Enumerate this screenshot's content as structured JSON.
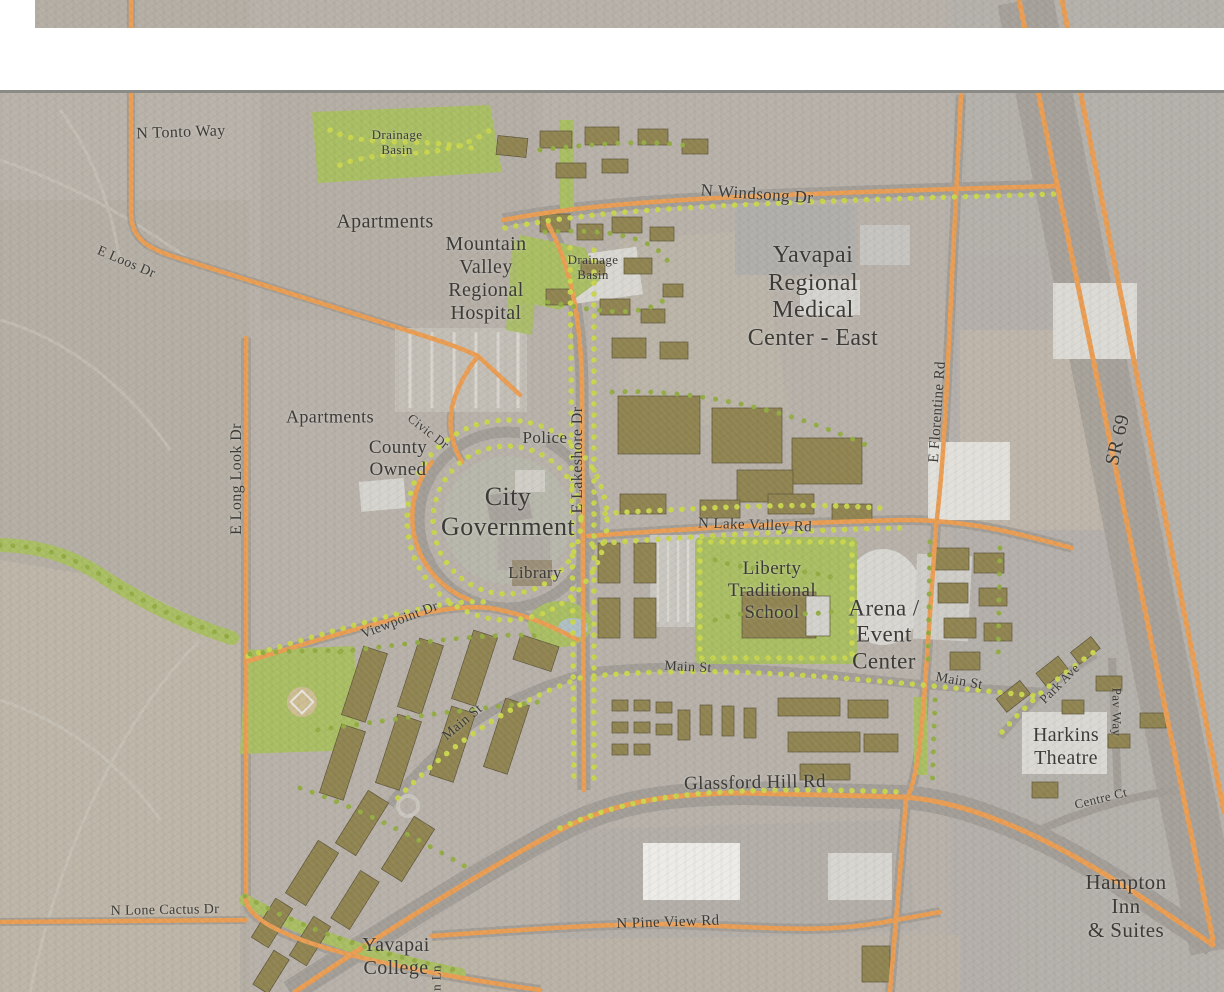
{
  "map": {
    "colors": {
      "map_base": "#B7B1A9",
      "white_band": "#FFFFFF",
      "border_line": "#8A8A86",
      "road_orange": "#EA9D52",
      "green_area": "#A9BE62",
      "building_olive": "#8F8350",
      "tree_dot": "#C9D64D",
      "tree_dot_dark": "#93AC43",
      "label_text": "#3C3B38",
      "highway_gray": "#A6A39E",
      "pond_blue": "#AEBFC4"
    },
    "labels": [
      {
        "t": "N Tonto Way",
        "x": 181,
        "y": 133,
        "r": -2,
        "fs": 16
      },
      {
        "t": "Drainage\nBasin",
        "x": 397,
        "y": 143,
        "r": 0,
        "fs": 13
      },
      {
        "t": "Apartments",
        "x": 385,
        "y": 222,
        "r": 0,
        "fs": 20
      },
      {
        "t": "Mountain\nValley\nRegional\nHospital",
        "x": 486,
        "y": 279,
        "r": 0,
        "fs": 20
      },
      {
        "t": "N Windsong Dr",
        "x": 757,
        "y": 194,
        "r": 4,
        "fs": 17
      },
      {
        "t": "Drainage\nBasin",
        "x": 593,
        "y": 268,
        "r": 0,
        "fs": 13
      },
      {
        "t": "Yavapai\nRegional\nMedical\nCenter - East",
        "x": 813,
        "y": 297,
        "r": 0,
        "fs": 24
      },
      {
        "t": "E Loos Dr",
        "x": 126,
        "y": 263,
        "r": 23,
        "fs": 14
      },
      {
        "t": "E Long Look Dr",
        "x": 237,
        "y": 479,
        "r": -90,
        "fs": 16
      },
      {
        "t": "Apartments",
        "x": 330,
        "y": 417,
        "r": 0,
        "fs": 18
      },
      {
        "t": "Civic Dr",
        "x": 428,
        "y": 432,
        "r": 38,
        "fs": 13
      },
      {
        "t": "County\nOwned",
        "x": 398,
        "y": 459,
        "r": 0,
        "fs": 19
      },
      {
        "t": "Police",
        "x": 545,
        "y": 438,
        "r": 0,
        "fs": 17
      },
      {
        "t": "City\nGovernment",
        "x": 508,
        "y": 512,
        "r": 0,
        "fs": 26
      },
      {
        "t": "Library",
        "x": 535,
        "y": 573,
        "r": 0,
        "fs": 17
      },
      {
        "t": "E Lakeshore Dr",
        "x": 578,
        "y": 460,
        "r": -90,
        "fs": 16
      },
      {
        "t": "N Lake Valley Rd",
        "x": 755,
        "y": 526,
        "r": 2,
        "fs": 15
      },
      {
        "t": "Liberty\nTraditional\nSchool",
        "x": 772,
        "y": 591,
        "r": 0,
        "fs": 19
      },
      {
        "t": "Arena /\nEvent\nCenter",
        "x": 884,
        "y": 635,
        "r": 0,
        "fs": 23
      },
      {
        "t": "E Florentine Rd",
        "x": 938,
        "y": 412,
        "r": -86,
        "fs": 15
      },
      {
        "t": "SR 69",
        "x": 1118,
        "y": 440,
        "r": -77,
        "fs": 20
      },
      {
        "t": "Viewpoint Dr",
        "x": 400,
        "y": 621,
        "r": -21,
        "fs": 14
      },
      {
        "t": "Main St",
        "x": 463,
        "y": 723,
        "r": -40,
        "fs": 14
      },
      {
        "t": "Main St",
        "x": 688,
        "y": 668,
        "r": 3,
        "fs": 14
      },
      {
        "t": "Main St",
        "x": 959,
        "y": 682,
        "r": 10,
        "fs": 14
      },
      {
        "t": "Park Ave",
        "x": 1060,
        "y": 684,
        "r": -45,
        "fs": 13
      },
      {
        "t": "Pav Way",
        "x": 1116,
        "y": 712,
        "r": 90,
        "fs": 13
      },
      {
        "t": "Harkins\nTheatre",
        "x": 1066,
        "y": 747,
        "r": 0,
        "fs": 20
      },
      {
        "t": "Glassford Hill Rd",
        "x": 755,
        "y": 783,
        "r": -1,
        "fs": 19
      },
      {
        "t": "Centre Ct",
        "x": 1101,
        "y": 799,
        "r": -14,
        "fs": 13
      },
      {
        "t": "Hampton Inn\n& Suites",
        "x": 1126,
        "y": 906,
        "r": 0,
        "fs": 21
      },
      {
        "t": "N Lone Cactus Dr",
        "x": 165,
        "y": 911,
        "r": -1,
        "fs": 14
      },
      {
        "t": "Yavapai\nCollege",
        "x": 396,
        "y": 957,
        "r": 0,
        "fs": 20
      },
      {
        "t": "N Pine View Rd",
        "x": 668,
        "y": 923,
        "r": -2,
        "fs": 15
      },
      {
        "t": "n Ln",
        "x": 437,
        "y": 978,
        "r": -90,
        "fs": 13
      }
    ]
  }
}
